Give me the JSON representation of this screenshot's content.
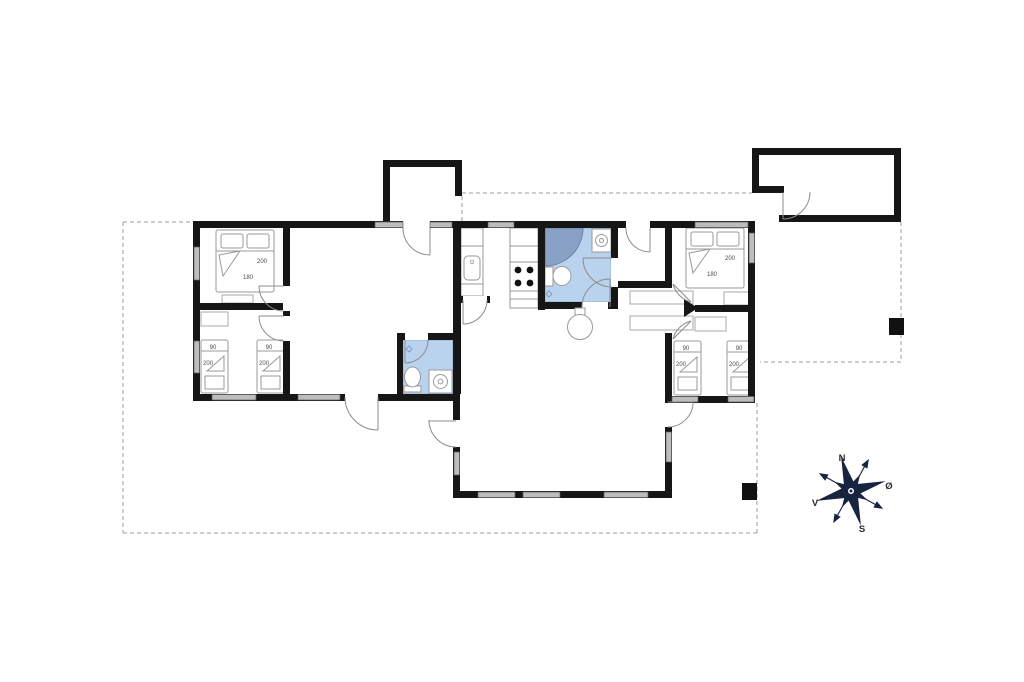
{
  "compass": {
    "north": "N",
    "south": "S",
    "east": "Ø",
    "west": "V"
  },
  "beds": {
    "left_double": {
      "length": "200",
      "width": "180"
    },
    "right_double": {
      "length": "200",
      "width": "180"
    },
    "left_single_1": {
      "width": "90",
      "length": "200"
    },
    "left_single_2": {
      "width": "90",
      "length": "200"
    },
    "right_single_1": {
      "width": "90",
      "length": "200"
    },
    "right_single_2": {
      "width": "90",
      "length": "200"
    }
  },
  "colors": {
    "wall": "#161616",
    "bathroom_floor": "#b9d3ee",
    "shower": "#8aa1c6",
    "window": "#bdbdbd",
    "compass_star": "#17233f",
    "plot_boundary": "#9e9e9e"
  }
}
